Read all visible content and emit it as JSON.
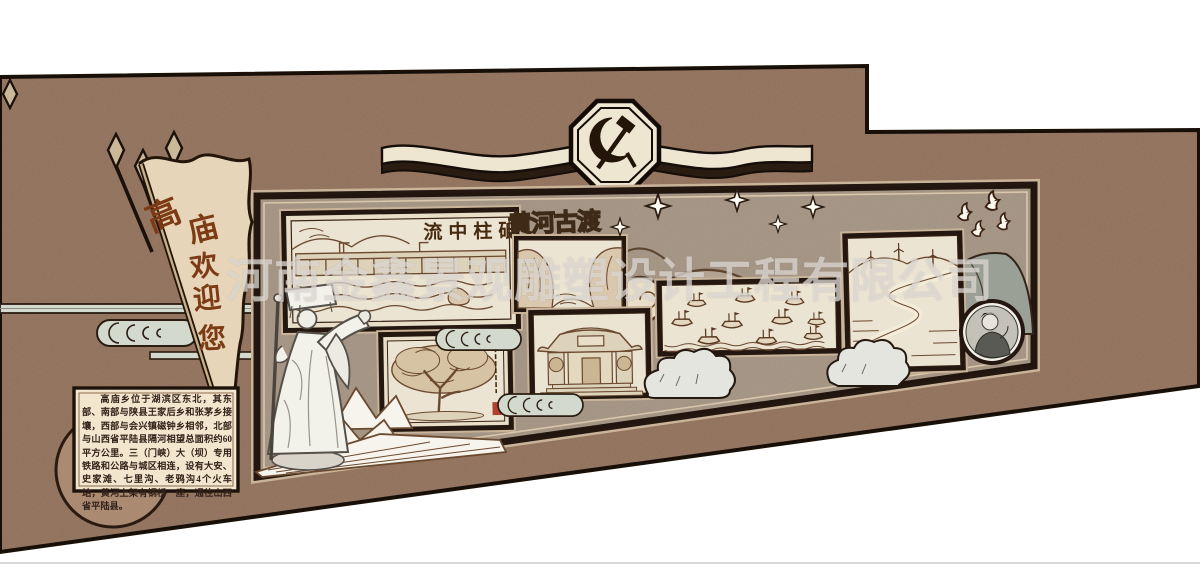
{
  "watermark": {
    "text": "河南金鑫景观雕塑设计工程有限公司",
    "color": "rgba(255,255,255,0.52)"
  },
  "flag": {
    "full_text": "高庙欢迎您",
    "chars": [
      "高",
      "庙",
      "欢",
      "迎",
      "您"
    ],
    "text_color": "#7c3a15"
  },
  "emblem": {
    "name": "party-emblem",
    "symbol": "hammer-and-sickle"
  },
  "panels": {
    "dam": {
      "title": "流中柱砥",
      "subject": "dam-landscape-sketch"
    },
    "gorge": {
      "title": "黄河古渡",
      "subject": "river-gorge-sketch"
    },
    "tree": {
      "subject": "ancient-tree-sketch"
    },
    "temple": {
      "subject": "temple-gate-sketch"
    },
    "boats": {
      "subject": "boat-fleet-sketch"
    },
    "road": {
      "subject": "mountain-road-wind-turbines-sketch"
    },
    "photo": {
      "subject": "herdsman-portrait-photo"
    }
  },
  "info_box": {
    "text": "高庙乡位于湖滨区东北，其东部、南部与陕县王家后乡和张茅乡接壤，西部与会兴镇磁钟乡相邻，北部与山西省平陆县隔河相望总面积约60平方公里。三（门峡）大（坝）专用铁路和公路与城区相连，设有大安、史家滩、七里沟、老鸦沟4个火车站，黄河上架有钢桥一座，通往山西省平陆县。"
  },
  "decorations": {
    "sparkle_stars": 5,
    "doves": 4,
    "spear_flags": 3,
    "cloud_scrolls": 4
  },
  "colors": {
    "wall": "#a5836c",
    "board": "#b3a291",
    "outline": "#1c120a",
    "cream": "#e9dfc9",
    "sketch_ink": "#6b4a30",
    "flag_text": "#7c3a15",
    "seal_red": "#b04030"
  }
}
